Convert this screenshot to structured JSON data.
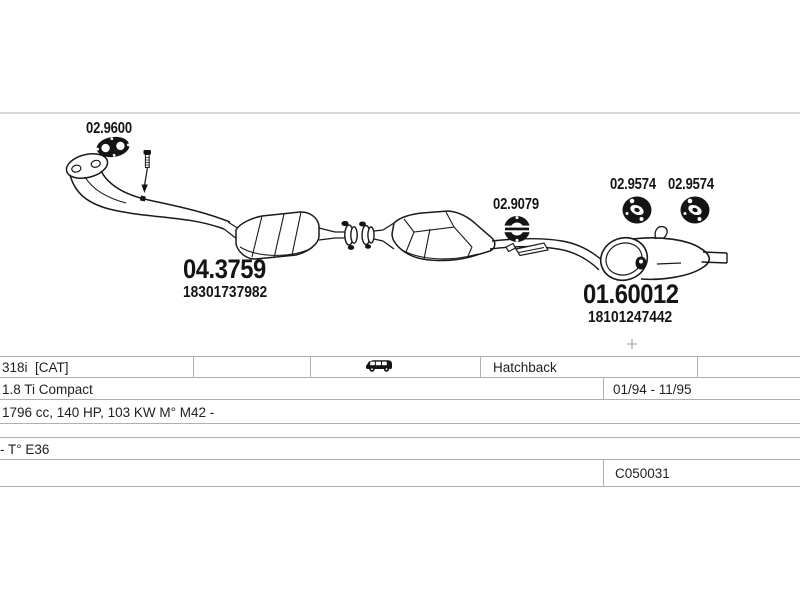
{
  "diagram": {
    "parts": {
      "gasket": {
        "code": "02.9600"
      },
      "catalytic_converter": {
        "code": "04.3759",
        "oe_number": "18301737982"
      },
      "mounting_ring": {
        "code": "02.9079"
      },
      "rubber_hanger_left": {
        "code": "02.9574"
      },
      "rubber_hanger_right": {
        "code": "02.9574"
      },
      "rear_silencer": {
        "code": "01.60012",
        "oe_number": "18101247442"
      }
    }
  },
  "vehicle_table": {
    "model": "318i  [CAT]",
    "body_type": "Hatchback",
    "version": "1.8 Ti Compact",
    "engine": "1796 cc, 140 HP, 103 KW M° M42 -",
    "chassis": "- T° E36",
    "build_period": "01/94 - 11/95",
    "catalog_code": "C050031"
  },
  "colors": {
    "line": "#1a1a1a",
    "table_border": "#b0b0b0",
    "top_rule": "#cccccc",
    "text": "#1f1f1f"
  }
}
